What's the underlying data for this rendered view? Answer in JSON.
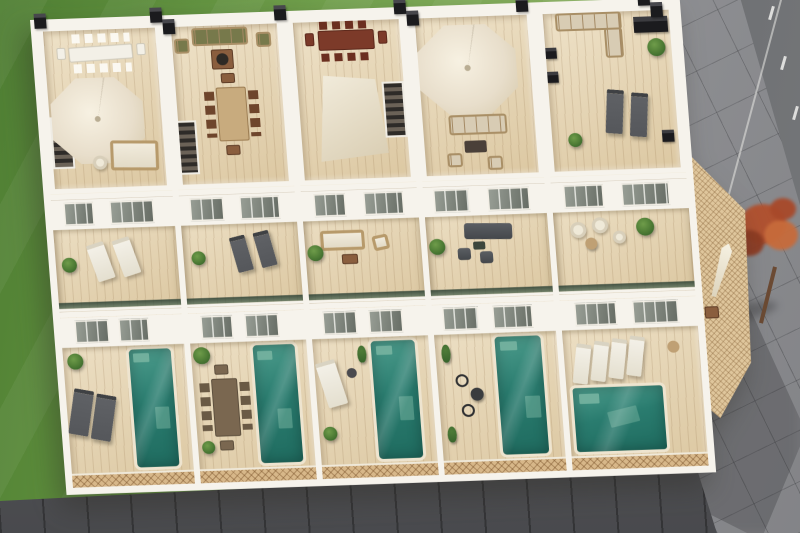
{
  "scene": {
    "description": "Aerial 3D architectural rendering of a terraced row of five white townhouses, each with a furnished rooftop solarium, a first-floor terrace and a ground-floor wooden patio with a private teal plunge pool, set beside a green lawn, a grey tiled sidewalk, an asphalt road and a dark plank walkway",
    "environment": {
      "lawn": "green lawn",
      "hedge": "lime-green hedge strip",
      "sidewalk": "grey diagonal-tiled pavement",
      "road": "asphalt road with dashed white lane line",
      "walkway": "dark plank walkway along the building front",
      "tree": "small red-leaved tree on the pavement",
      "building": "row of five white three-level townhouses with wooden decks"
    },
    "houses": [
      {
        "name": "Townhouse 1",
        "roof_terrace": [
          "long white dining table with eight white chairs",
          "large cream octagonal cantilever parasol",
          "rattan lounge sofa with white cushions",
          "roof stair access",
          "black chimney caps"
        ],
        "first_floor_terrace": [
          "two white sun loungers",
          "potted plant",
          "green glass balustrade"
        ],
        "ground_patio": [
          "two anthracite sun loungers",
          "potted palm",
          "teal plunge pool",
          "latticed timber fence"
        ]
      },
      {
        "name": "Townhouse 2",
        "roof_terrace": [
          "wooden sofa with olive-green cushions",
          "two armchairs",
          "square coffee table with round top",
          "light wood dining table with six chairs",
          "roof stair access"
        ],
        "first_floor_terrace": [
          "two grey sun loungers",
          "potted plant"
        ],
        "ground_patio": [
          "grey-wood dining table with eight chairs",
          "potted palm",
          "teal plunge pool",
          "latticed timber fence"
        ]
      },
      {
        "name": "Townhouse 3",
        "roof_terrace": [
          "dark red-brown dining table with six chairs",
          "white canvas shade sail",
          "roof stair access"
        ],
        "first_floor_terrace": [
          "cream outdoor sofa",
          "armchair",
          "wooden coffee table",
          "potted tree"
        ],
        "ground_patio": [
          "white lounge chair",
          "side table",
          "cypress shrubs",
          "teal plunge pool",
          "latticed timber fence"
        ]
      },
      {
        "name": "Townhouse 4",
        "roof_terrace": [
          "large cream octagonal parasol",
          "beige outdoor sofa",
          "dark coffee table",
          "two wicker armchairs"
        ],
        "first_floor_terrace": [
          "anthracite outdoor sofa",
          "two dark chairs",
          "side table",
          "potted tree"
        ],
        "ground_patio": [
          "two black wire bistro chairs",
          "round bistro table",
          "cypress shrubs",
          "teal plunge pool",
          "latticed timber fence"
        ]
      },
      {
        "name": "Townhouse 5",
        "roof_terrace": [
          "corner sofa with beige cushions",
          "black outdoor kitchen unit",
          "black planter boxes",
          "two grey sun loungers",
          "potted plants"
        ],
        "first_floor_terrace": [
          "two white wicker chairs",
          "round side table",
          "white pouf",
          "potted palm"
        ],
        "ground_patio": [
          "four white slatted sun loungers",
          "large teal pool",
          "latticed side sun-deck",
          "folded white parasol"
        ]
      }
    ]
  },
  "palette": {
    "grass": "#6fa047",
    "grass_light": "#8ab45a",
    "grass_dark": "#4f7f33",
    "hedge": "#a9c355",
    "pavement": "#95969a",
    "road": "#6d6f72",
    "road_line": "#e9e9e7",
    "walkway": "#55565a",
    "wall": "#f6f3ec",
    "deck": "#e7d5b0",
    "pool": "#2a7c6f",
    "pool_light": "#79b5a2",
    "lattice": "#d7b789",
    "lattice_light": "#dfc69c",
    "wood": "#8a5e3e",
    "wood_red": "#7c3a29",
    "wood_gray": "#7a6750",
    "tan": "#bfa074",
    "cushion": "#d8ccb4",
    "olive": "#77794b",
    "anthracite": "#55575b",
    "white_furn": "#f3f0e7",
    "green": "#4c7a34",
    "green_dark": "#35612a",
    "black": "#1b1b1e",
    "cream": "#e8decb",
    "trunk": "#6b4a33",
    "tree_red": "#b2502d"
  }
}
